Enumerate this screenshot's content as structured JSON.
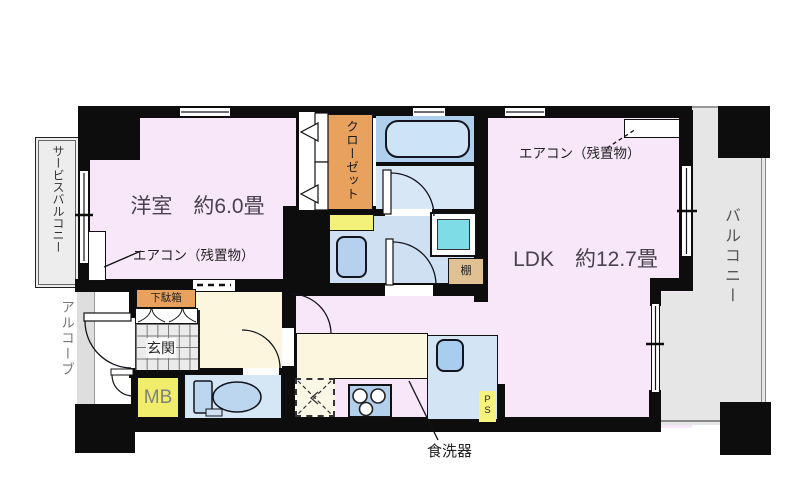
{
  "floorplan": {
    "labels": {
      "western_room": "洋室　約6.0畳",
      "ldk": "LDK　約12.7畳",
      "closet": "クローゼット",
      "aircon_note": "エアコン（残置物）",
      "service_balcony": "サービスバルコニー",
      "balcony": "バルコニー",
      "alcove": "アルコーブ",
      "entrance": "玄関",
      "shoe_cabinet": "下駄箱",
      "meter_box": "MB",
      "pipe_space": "PS",
      "shelf": "棚",
      "dishwasher": "食洗器"
    },
    "colors": {
      "wall": "#0d0d0d",
      "room_pink": "#f8e7f8",
      "hall_cream": "#fbf6dd",
      "bath_blue": "#aed0ee",
      "water_blue": "#d5e6f5",
      "washer_teal": "#7edce7",
      "closet_orange": "#e9a15e",
      "shelf_tan": "#e0c193",
      "mb_yellow": "#f0ed6d",
      "ps_yellow": "#f5f27d",
      "balcony_grey": "#e6e6e6"
    }
  }
}
